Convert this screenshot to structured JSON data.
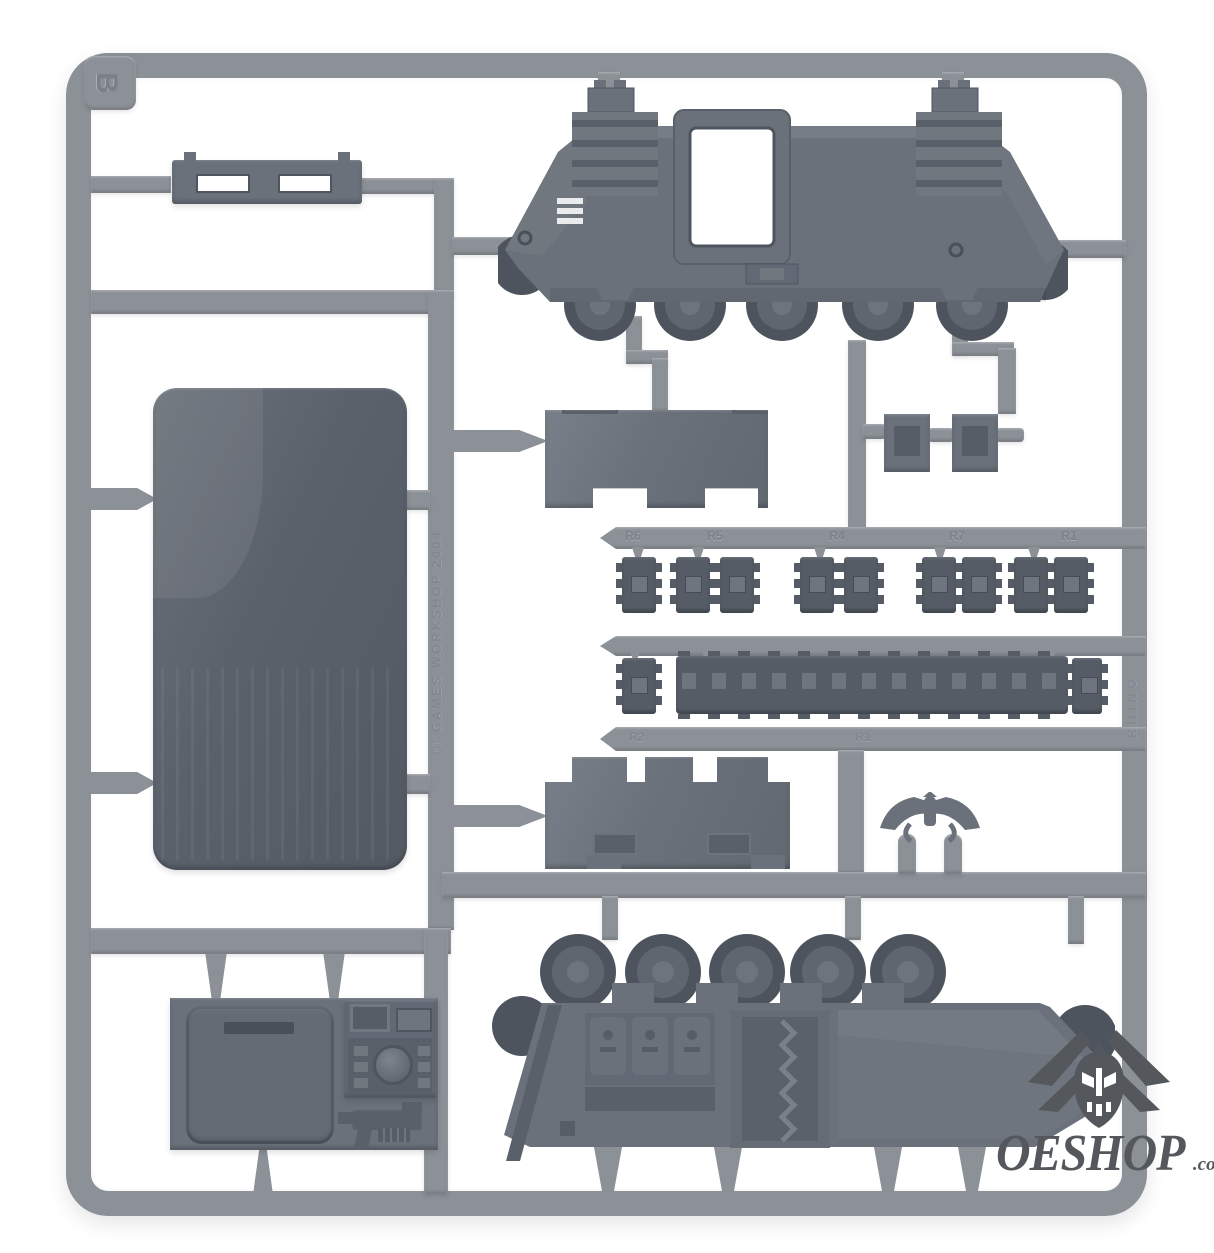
{
  "photo": {
    "background": "#ffffff",
    "subject": "grey plastic model-kit sprue (tank frame B) product photo"
  },
  "sprue": {
    "frame_letter": "B",
    "copyright_text": "© GAMES WORKSHOP 2004",
    "frame_code_text": "RHINO",
    "runner_labels": [
      "R6",
      "R5",
      "R4",
      "R7",
      "R1"
    ],
    "track_bar_labels": [
      "R2",
      "R1"
    ],
    "colors": {
      "frame": "#8b9197",
      "part": "#6a717b",
      "part-dark": "#5a616b",
      "track": "#555c66",
      "wheel": "#4d545e",
      "emboss": "#787f87"
    }
  },
  "watermark": {
    "brand": "OESHOP",
    "tld": ".co.uk",
    "color": "#54585c"
  },
  "pieces": [
    "hull-side-outer",
    "towing-step-plate",
    "floor-panel",
    "engine-deck-panel",
    "mounting-brackets",
    "track-link-sets",
    "track-run",
    "rear-hatch-panel",
    "aquila-ornament",
    "hull-side-inner",
    "hatch-door",
    "control-console",
    "bolter"
  ]
}
